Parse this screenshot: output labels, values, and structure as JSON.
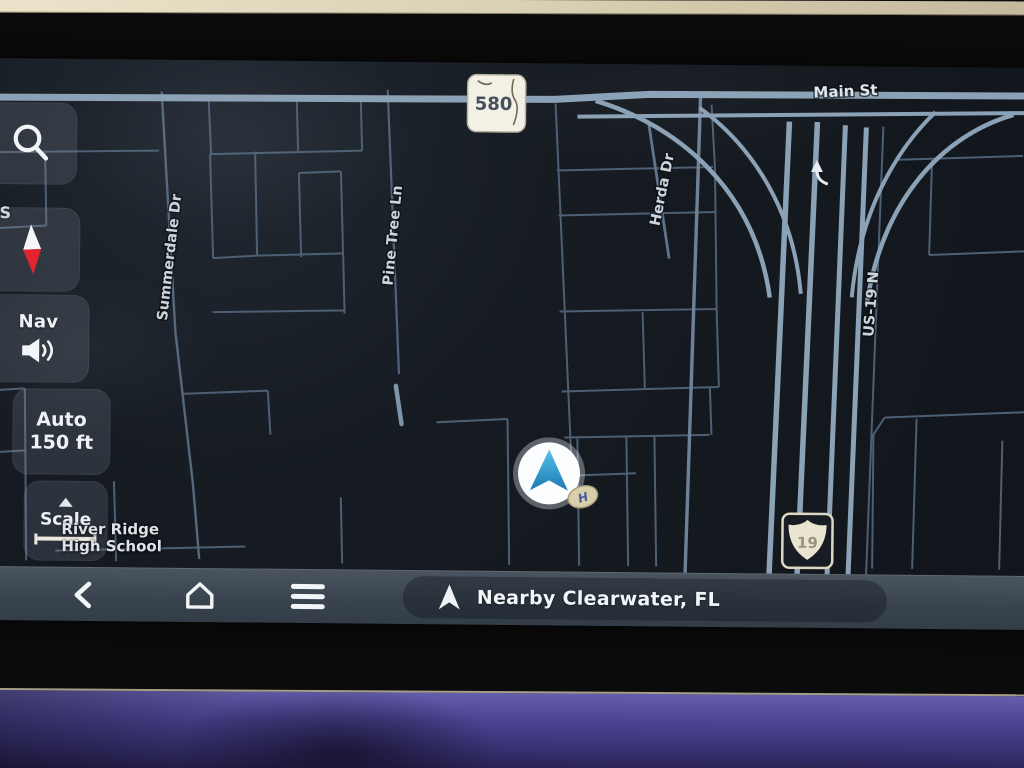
{
  "map": {
    "streets": {
      "summerdale": "Summerdale Dr",
      "pine_tree": "Pine Tree Ln",
      "herda": "Herda Dr",
      "main_st": "Main St",
      "us19": "US-19 N",
      "edge_partial": "S"
    },
    "poi": {
      "line1": "River Ridge",
      "line2": "High School"
    },
    "shields": {
      "fl_580": "580",
      "us_19": "19"
    },
    "vehicle": {
      "badge": "H"
    }
  },
  "sidebar": {
    "nav_volume": {
      "label": "Nav"
    },
    "zoom": {
      "mode": "Auto",
      "scale": "150 ft"
    },
    "scale": {
      "label": "Scale"
    }
  },
  "bottom_bar": {
    "destination": "Nearby Clearwater, FL"
  },
  "colors": {
    "map_bg": "#141920",
    "road_main": "#8ba1b6",
    "road_minor": "#4d5f73",
    "bar_bg": "#3e4852",
    "marker_arrow": "#35a3d4",
    "compass_red": "#e32430",
    "dash_ambient": "#4c4595"
  }
}
